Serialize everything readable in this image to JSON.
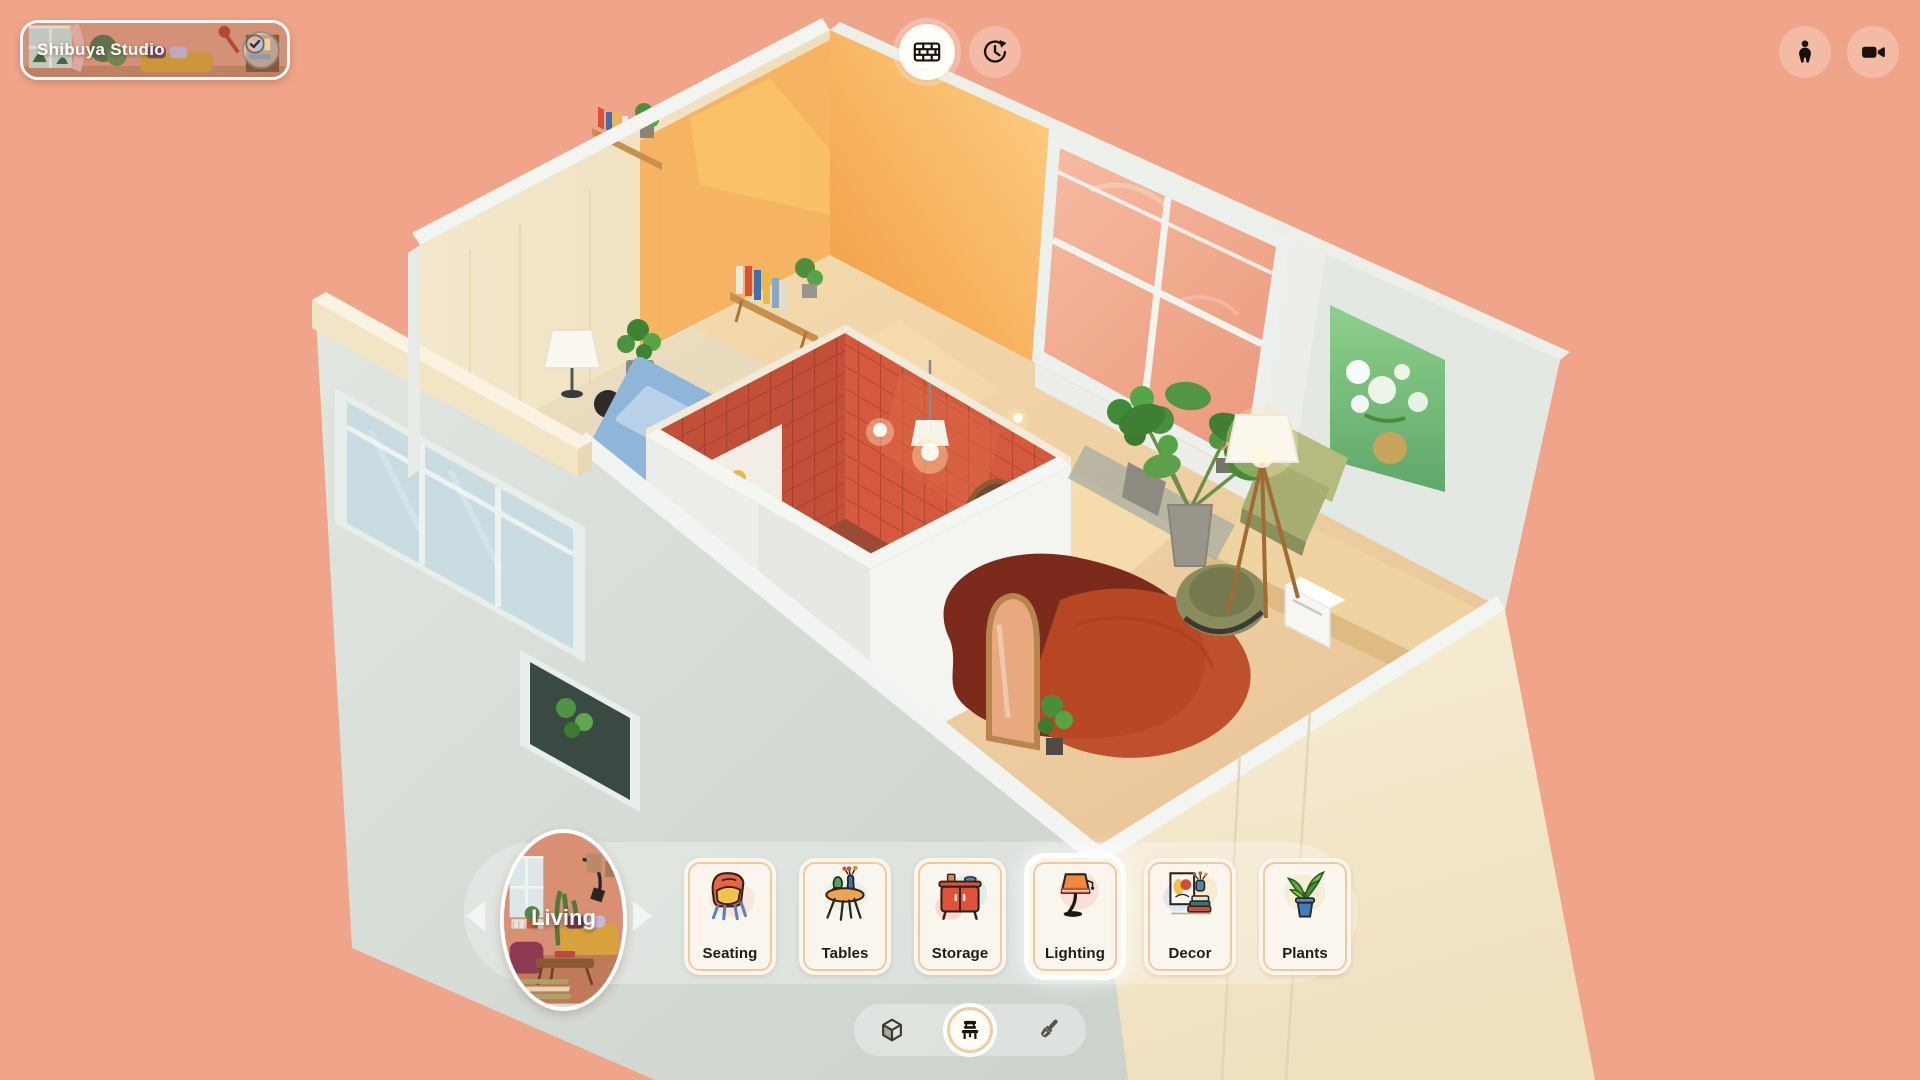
{
  "app": {
    "background_color": "#F0A58A",
    "accent_color": "#F1C9A0",
    "panel_color": "rgba(255,255,255,0.3)"
  },
  "header": {
    "project_title": "Shibuya Studio",
    "badge_icon": "check-icon"
  },
  "top_center_buttons": [
    {
      "id": "wall-view",
      "icon": "brick-wall-icon",
      "active": true
    },
    {
      "id": "history",
      "icon": "history-clock-icon",
      "active": false
    }
  ],
  "top_right_buttons": [
    {
      "id": "character",
      "icon": "person-icon"
    },
    {
      "id": "camera",
      "icon": "video-camera-icon"
    }
  ],
  "room_selector": {
    "current_room": "Living",
    "has_prev": true,
    "has_next": true
  },
  "categories": [
    {
      "label": "Seating",
      "icon": "armchair-illustration",
      "highlighted": false
    },
    {
      "label": "Tables",
      "icon": "side-table-illustration",
      "highlighted": false
    },
    {
      "label": "Storage",
      "icon": "cabinet-illustration",
      "highlighted": false
    },
    {
      "label": "Lighting",
      "icon": "table-lamp-illustration",
      "highlighted": true
    },
    {
      "label": "Decor",
      "icon": "frame-books-illustration",
      "highlighted": false
    },
    {
      "label": "Plants",
      "icon": "potted-plant-illustration",
      "highlighted": false
    }
  ],
  "mode_bar": {
    "modes": [
      {
        "id": "build",
        "icon": "cube-icon",
        "selected": false
      },
      {
        "id": "furnish",
        "icon": "chair-icon",
        "selected": true
      },
      {
        "id": "paint",
        "icon": "paintbrush-icon",
        "selected": false
      }
    ]
  },
  "scene": {
    "view": "isometric dollhouse apartment",
    "colors": {
      "background": "#F0A58A",
      "outer_wall": "#D8DED8",
      "outer_wall_cream": "#F4EBD2",
      "plywood_wall": "#F1E5C8",
      "sunlit_wall": "#F7AC52",
      "window_glass": "#F2AE93",
      "floor_wood": "#EFD2A6",
      "bathroom_tile": "#C8503A",
      "bed_blue": "#8FB6D8",
      "rug_dark_red": "#7C2A1C",
      "rug_orange_red": "#BC4A26",
      "painting_green": "#7CC27E",
      "plant_green": "#3F7F33"
    }
  }
}
